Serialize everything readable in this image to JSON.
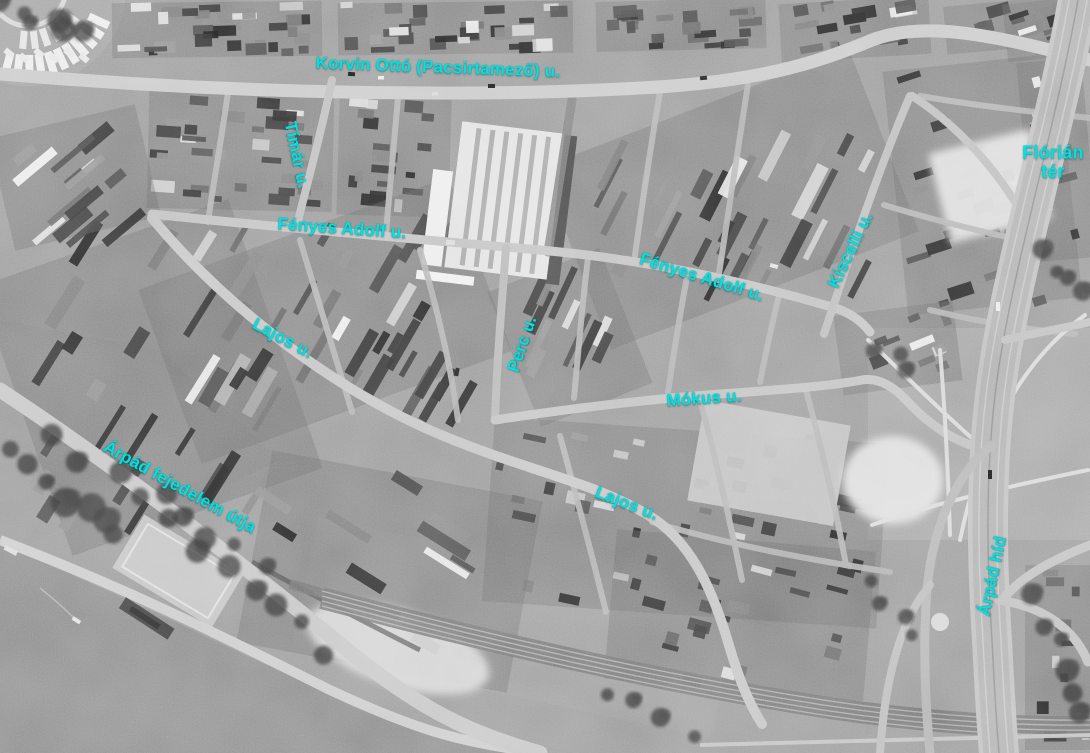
{
  "map": {
    "label_color": "#00e1e1",
    "labels": [
      {
        "text": "Korvin Ottó (Pacsirtamező) u."
      },
      {
        "text": "Tímár u."
      },
      {
        "text": "Fényes Adolf u."
      },
      {
        "text": "Fényes Adolf u."
      },
      {
        "text": "Flórián tér"
      },
      {
        "text": "Kiscelli u."
      },
      {
        "text": "Lajos u."
      },
      {
        "text": "Perc u."
      },
      {
        "text": "Mókus u."
      },
      {
        "text": "Árpád fejedelem útja"
      },
      {
        "text": "Lajos u."
      },
      {
        "text": "Árpád híd"
      }
    ]
  }
}
